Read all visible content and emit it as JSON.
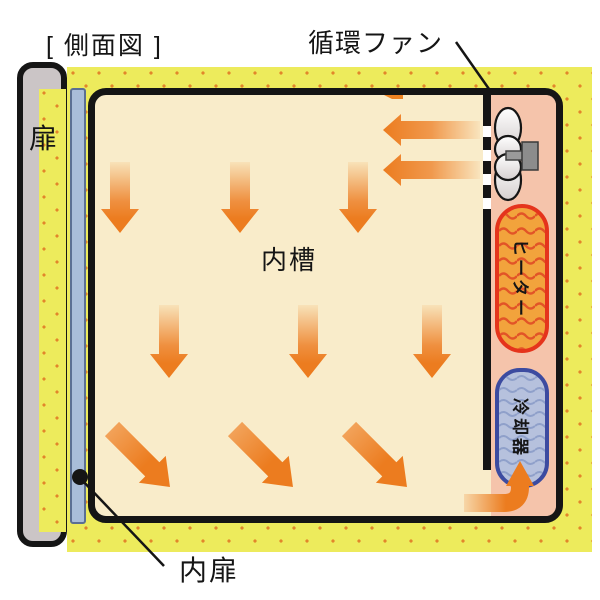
{
  "title": "[ 側面図 ]",
  "diagram": {
    "fan_label": "循環ファン",
    "door_label": "扉",
    "inner_chamber_label": "内槽",
    "inner_door_label": "内扉",
    "heater_label": "ヒーター",
    "cooler_label": "冷却器"
  },
  "colors": {
    "insulation_yellow": "#edeb5c",
    "insulation_dot": "#e2862a",
    "chamber_cream": "#f9ecca",
    "compartment_pink": "#f5c4ab",
    "arrow_orange": "#ec7c1f",
    "heater_fill": "#f2a33c",
    "heater_border": "#e5341c",
    "heater_wave": "#e25427",
    "cooler_fill": "#b6c1dd",
    "cooler_border": "#3c4ba0",
    "cooler_wave": "#8fa0ca",
    "inner_door_blue": "#a9bdd9",
    "door_gray": "#cbc5c6",
    "outline_black": "#151515"
  }
}
